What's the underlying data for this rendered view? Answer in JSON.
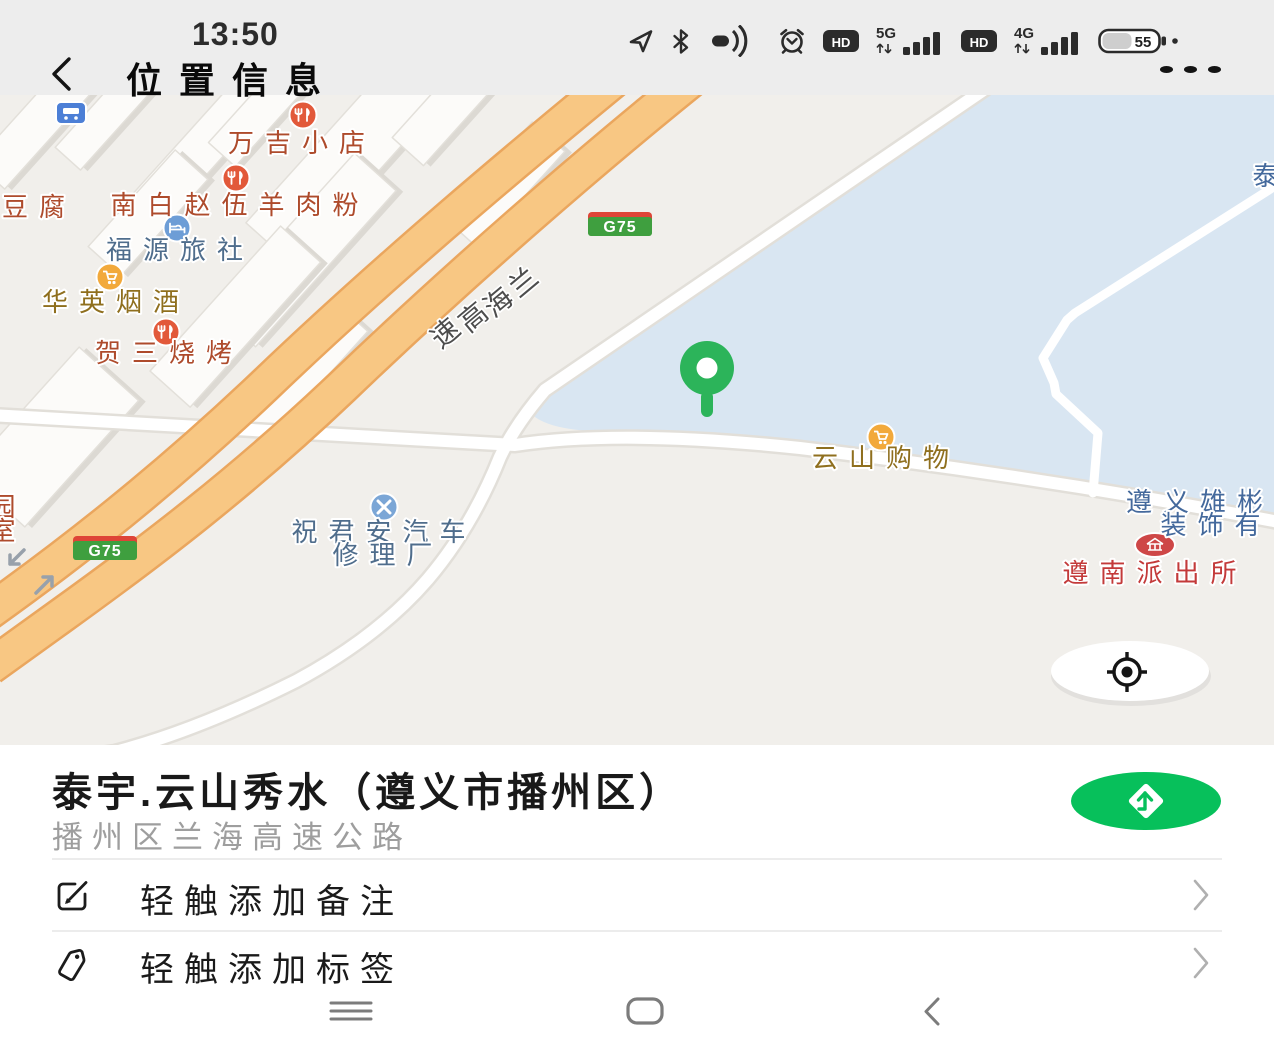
{
  "status_bar": {
    "time": "13:50",
    "hd": "HD",
    "net_5g": "5G",
    "net_4g": "4G",
    "battery_percent": "55",
    "icon_names": [
      "location-arrow-icon",
      "bluetooth-icon",
      "one-hand-mode-icon",
      "alarm-icon",
      "hd-icon",
      "signal-5g-icon",
      "hd-icon",
      "signal-4g-icon",
      "battery-icon"
    ]
  },
  "header": {
    "title": "位置信息",
    "back_icon": "chevron-left",
    "more_icon": "ellipsis"
  },
  "map": {
    "expressway_chars": [
      "兰",
      "海",
      "高",
      "速"
    ],
    "badges": [
      {
        "label": "G75"
      },
      {
        "label": "G75"
      }
    ],
    "pois": {
      "wanji": "万吉小店",
      "nanbai": "南白赵伍羊肉粉",
      "fuyuan": "福源旅社",
      "huaying": "华英烟酒",
      "hesan": "贺三烧烤",
      "repair1": "祝君安汽车",
      "repair2": "修理厂",
      "yunshan": "云山购物",
      "xiongbin1": "遵义雄彬",
      "xiongbin2": "装饰有",
      "police": "遵南派出所",
      "doufu": "豆腐",
      "yuan": "园",
      "shi": "室",
      "partial_top_right": "泰"
    },
    "marker": "location-pin",
    "locate_button": "my-location"
  },
  "panel": {
    "title": "泰宇.云山秀水（遵义市播州区）",
    "subtitle": "播州区兰海高速公路",
    "note_action": "轻触添加备注",
    "tag_action": "轻触添加标签",
    "nav_button": "navigate"
  },
  "system_nav": {
    "icon_names": [
      "menu-icon",
      "recents-icon",
      "back-icon"
    ]
  },
  "colors": {
    "wechat_green": "#07c05b",
    "pin_green": "#2cb45a",
    "water": "#d9e6f2",
    "land": "#f1efeb",
    "highway_fill": "#f8c783",
    "highway_casing": "#eaa65e",
    "badge_green": "#3f9f3f",
    "badge_red": "#de4437",
    "poi_red": "#ae4b2c",
    "poi_blue": "#4f6d8c",
    "poi_yellow": "#8f6f1e",
    "police_red": "#c33a3a",
    "company_blue": "#44699c"
  }
}
